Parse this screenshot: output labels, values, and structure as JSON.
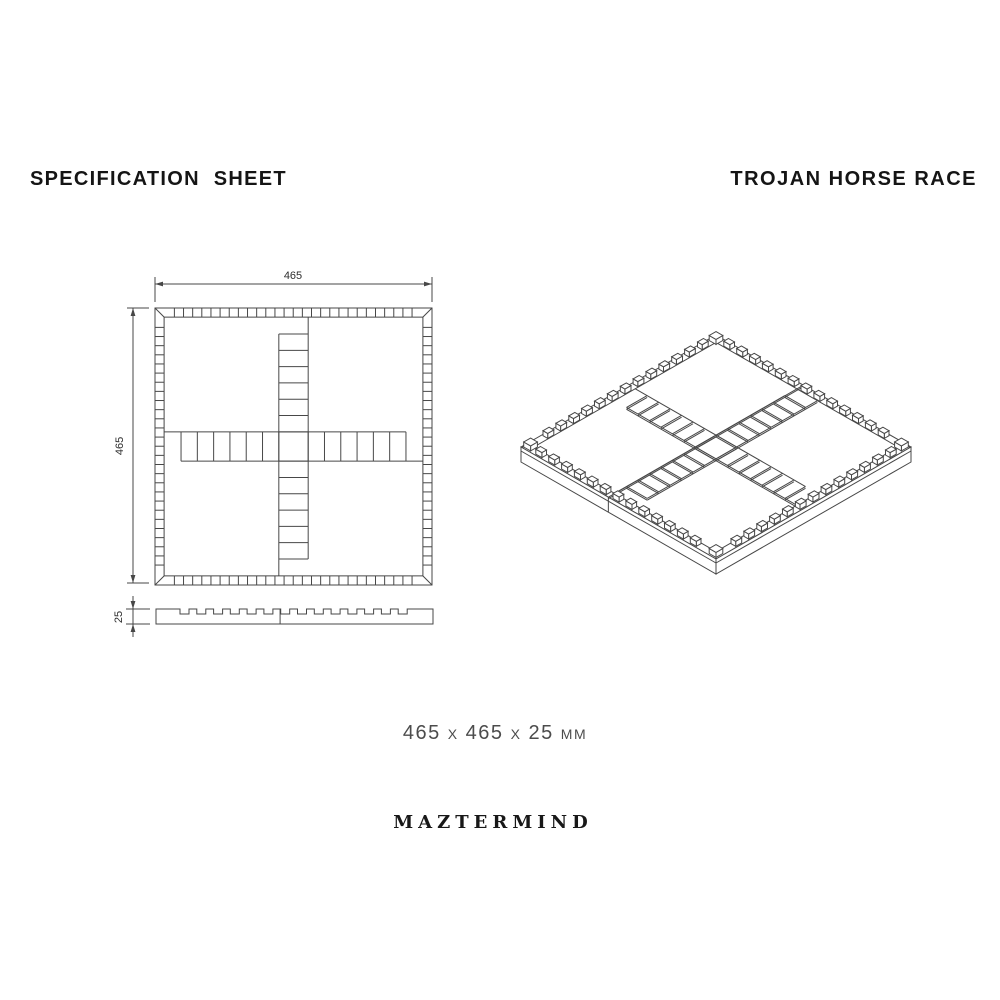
{
  "header": {
    "sheet_title": "SPECIFICATION SHEET",
    "product_title": "TROJAN HORSE RACE"
  },
  "dimensions": {
    "width_label": "465",
    "height_label": "465",
    "thickness_label": "25",
    "summary": "465 x 465 x 25 mm"
  },
  "brand": {
    "logo_text": "MAZTERMIND"
  },
  "drawing": {
    "line_color": "#474747",
    "background": "#ffffff",
    "views": {
      "top": "top-view",
      "side": "side-view",
      "iso": "isometric-view"
    }
  }
}
